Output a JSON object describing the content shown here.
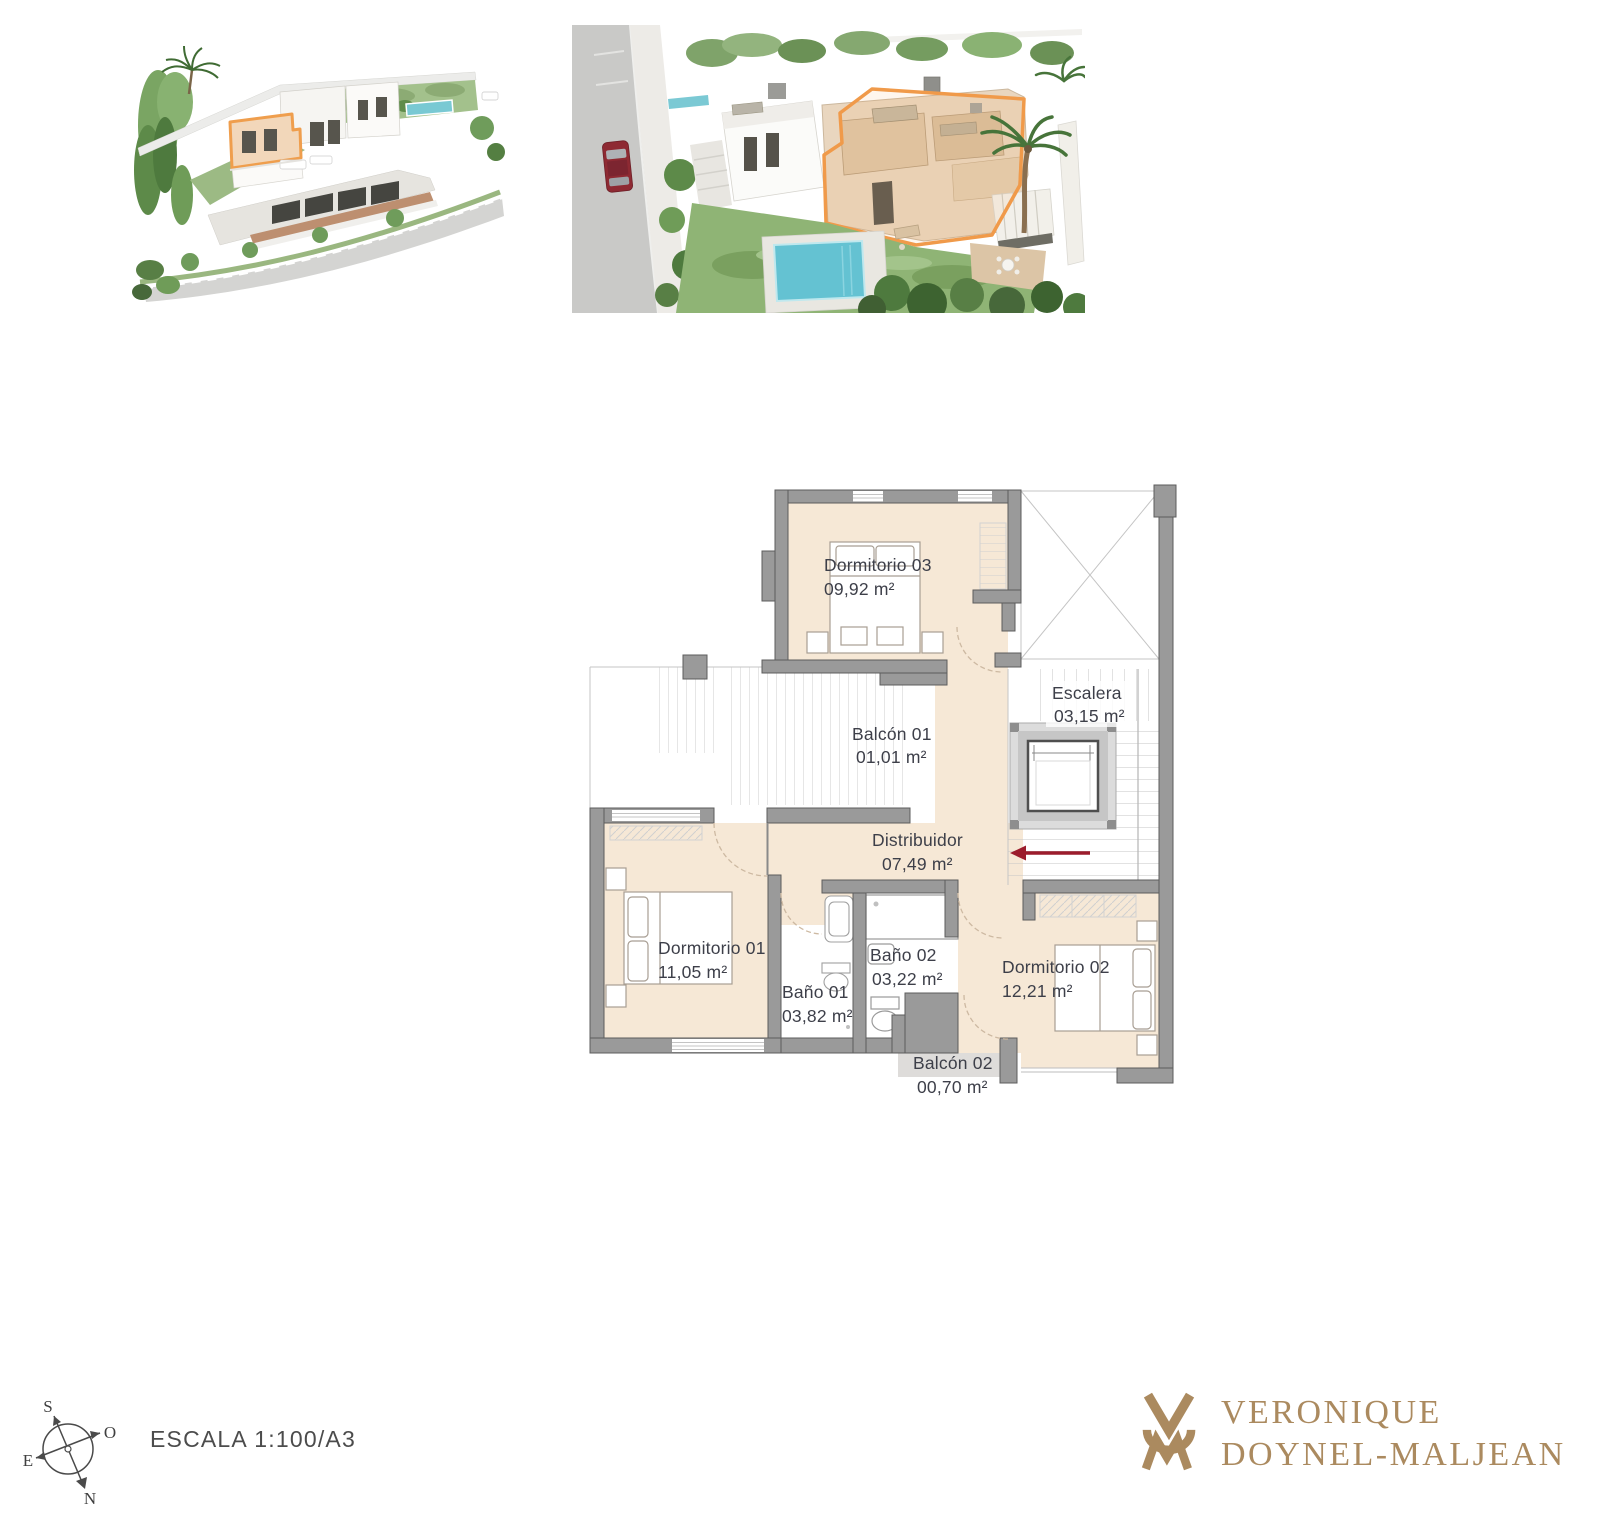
{
  "document": {
    "background": "#ffffff",
    "type": "architectural-plan-sheet"
  },
  "renders": {
    "wide": {
      "label": "aerial-render-wide"
    },
    "closeup": {
      "label": "aerial-render-closeup"
    },
    "highlight_color": "#f09a4a"
  },
  "floorplan": {
    "rooms": [
      {
        "id": "dormitorio-03",
        "name": "Dormitorio 03",
        "area": "09,92 m²"
      },
      {
        "id": "escalera",
        "name": "Escalera",
        "area": "03,15 m²"
      },
      {
        "id": "balcon-01",
        "name": "Balcón 01",
        "area": "01,01 m²"
      },
      {
        "id": "distribuidor",
        "name": "Distribuidor",
        "area": "07,49 m²"
      },
      {
        "id": "dormitorio-01",
        "name": "Dormitorio 01",
        "area": "11,05 m²"
      },
      {
        "id": "bano-01",
        "name": "Baño 01",
        "area": "03,82 m²"
      },
      {
        "id": "bano-02",
        "name": "Baño 02",
        "area": "03,22 m²"
      },
      {
        "id": "dormitorio-02",
        "name": "Dormitorio 02",
        "area": "12,21 m²"
      },
      {
        "id": "balcon-02",
        "name": "Balcón 02",
        "area": "00,70 m²"
      }
    ],
    "colors": {
      "floor": "#f6e8d6",
      "wall": "#9a9a9a",
      "balcony_floor": "#dedcda",
      "text": "#3d3f49",
      "entry_arrow": "#9c1c2c"
    }
  },
  "compass": {
    "s": "S",
    "n": "N",
    "e": "E",
    "o": "O"
  },
  "scale_label": "ESCALA 1:100/A3",
  "brand": {
    "line1": "VERONIQUE",
    "line2": "DOYNEL-MALJEAN",
    "color": "#ab8a5f"
  }
}
